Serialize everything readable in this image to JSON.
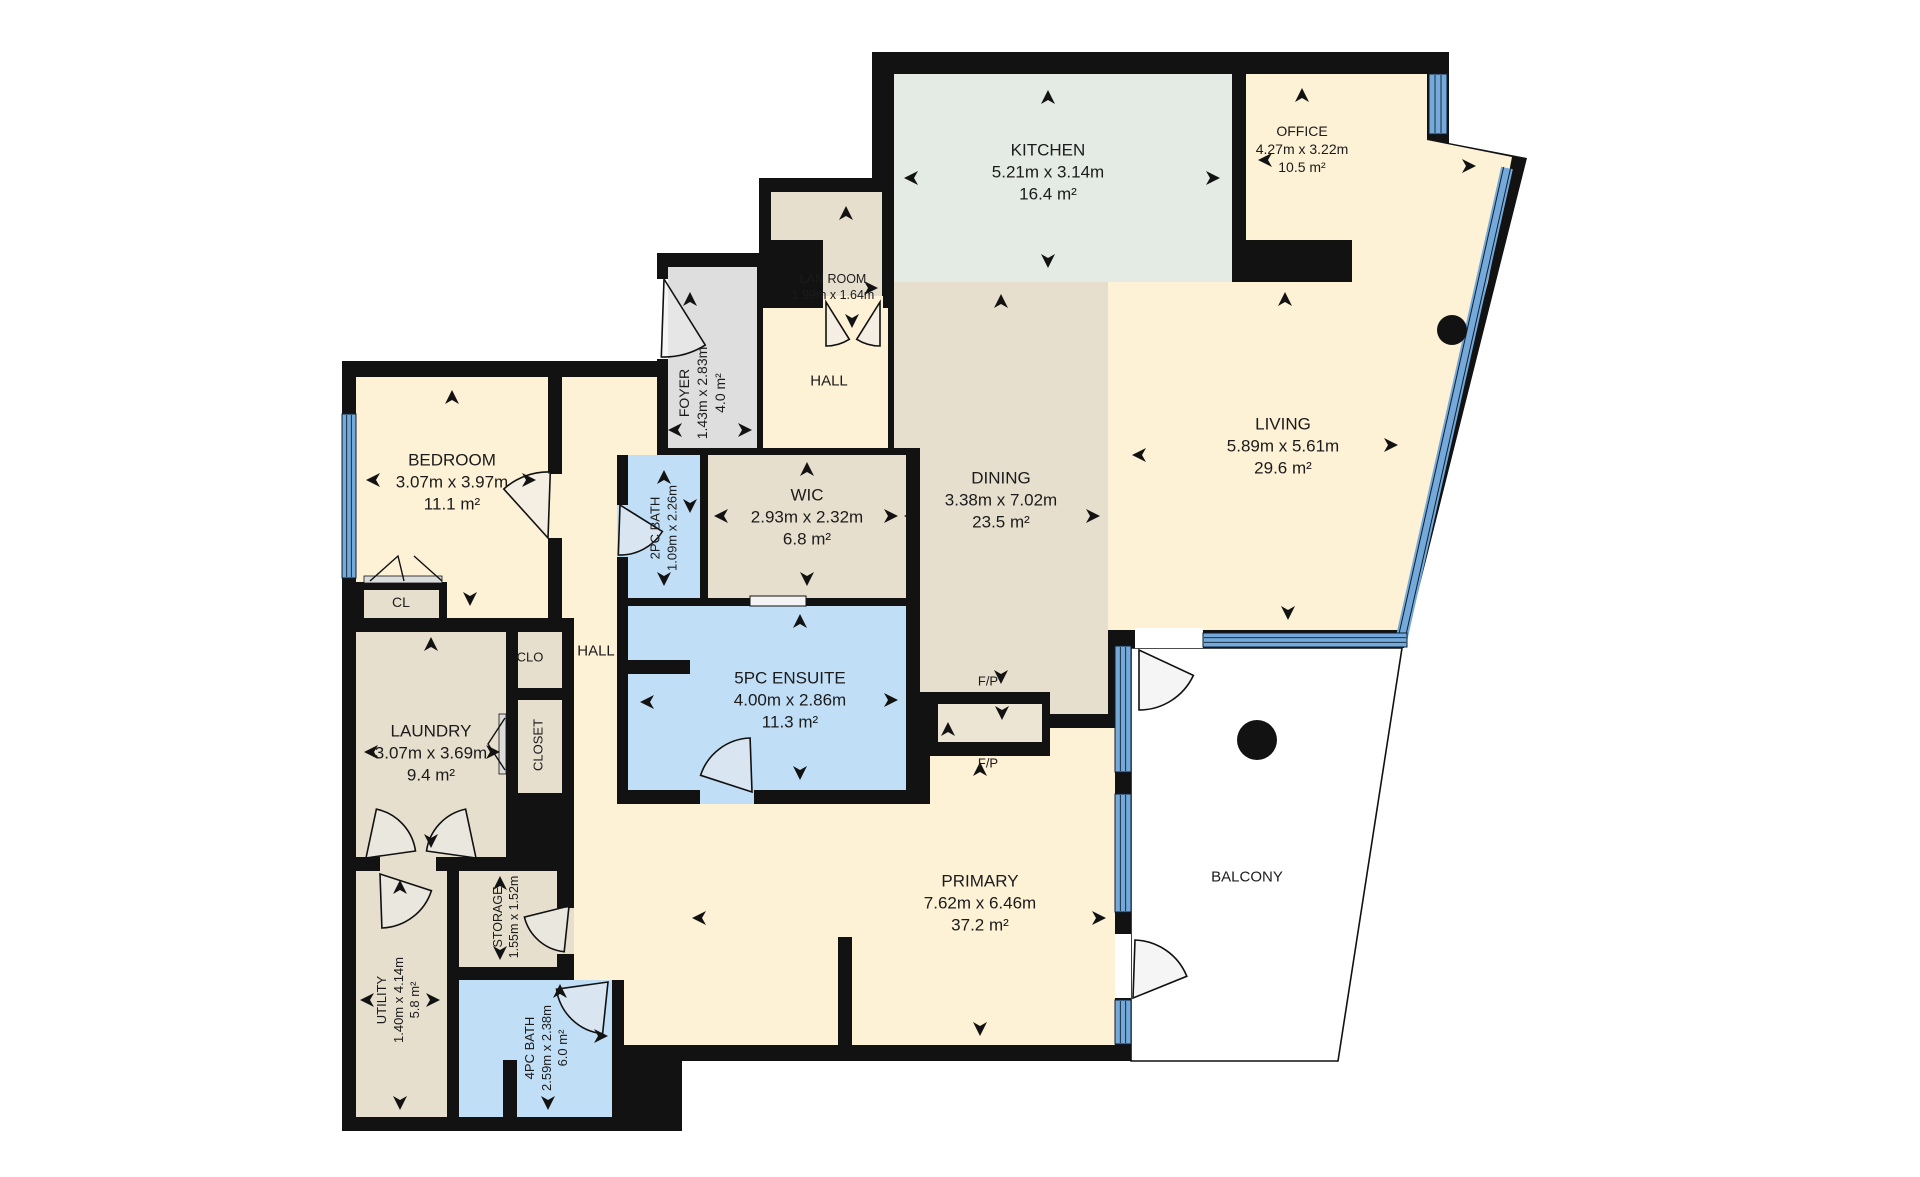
{
  "plan": {
    "title": "Floor plan",
    "rooms": {
      "kitchen": {
        "name": "KITCHEN",
        "dims": "5.21m x 3.14m",
        "area": "16.4 m²"
      },
      "office": {
        "name": "OFFICE",
        "dims": "4.27m x 3.22m",
        "area": "10.5 m²"
      },
      "lan_room": {
        "name": "LAN ROOM",
        "dims": "1.99m x 1.64m"
      },
      "foyer": {
        "name": "FOYER",
        "dims": "1.43m x 2.83m",
        "area": "4.0 m²"
      },
      "hall_upper": {
        "name": "HALL"
      },
      "hall_lower": {
        "name": "HALL"
      },
      "bedroom": {
        "name": "BEDROOM",
        "dims": "3.07m x 3.97m",
        "area": "11.1 m²"
      },
      "cl": {
        "name": "CL"
      },
      "clo": {
        "name": "CLO"
      },
      "closet": {
        "name": "CLOSET"
      },
      "bath_2pc": {
        "name": "2PC BATH",
        "dims": "1.09m x 2.26m"
      },
      "wic": {
        "name": "WIC",
        "dims": "2.93m x 2.32m",
        "area": "6.8 m²"
      },
      "dining": {
        "name": "DINING",
        "dims": "3.38m x 7.02m",
        "area": "23.5 m²"
      },
      "living": {
        "name": "LIVING",
        "dims": "5.89m x 5.61m",
        "area": "29.6 m²"
      },
      "laundry": {
        "name": "LAUNDRY",
        "dims": "3.07m x 3.69m",
        "area": "9.4 m²"
      },
      "ensuite_5pc": {
        "name": "5PC ENSUITE",
        "dims": "4.00m x 2.86m",
        "area": "11.3 m²"
      },
      "fp_upper": {
        "name": "F/P"
      },
      "fp_lower": {
        "name": "F/P"
      },
      "primary": {
        "name": "PRIMARY",
        "dims": "7.62m x 6.46m",
        "area": "37.2 m²"
      },
      "balcony": {
        "name": "BALCONY"
      },
      "utility": {
        "name": "UTILITY",
        "dims": "1.40m x 4.14m",
        "area": "5.8 m²"
      },
      "storage": {
        "name": "STORAGE",
        "dims": "1.55m x 1.52m"
      },
      "bath_4pc": {
        "name": "4PC BATH",
        "dims": "2.59m x 2.38m",
        "area": "6.0 m²"
      }
    },
    "colors": {
      "wall": "#121212",
      "room_cream": "#fdf1d6",
      "room_tan": "#e7dfce",
      "room_sage": "#e3ebe4",
      "room_blue": "#c0def6",
      "room_gray": "#dedede",
      "balcony": "#ffffff",
      "window": "#74a9da",
      "text": "#1b1b1b"
    }
  }
}
